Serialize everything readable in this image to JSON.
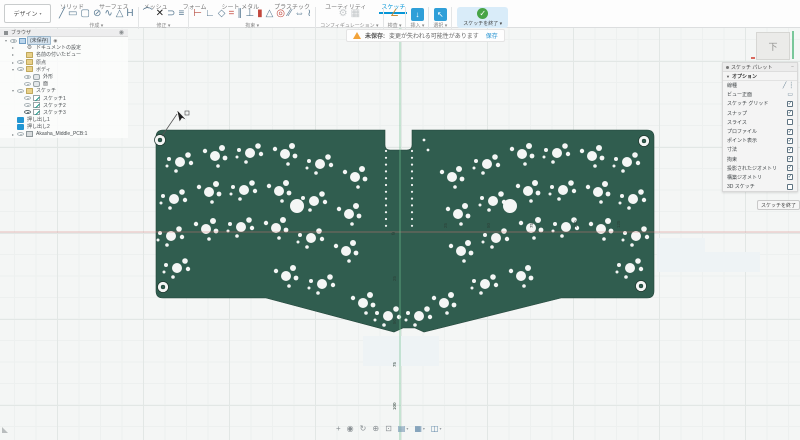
{
  "toolbar": {
    "design_label": "デザイン",
    "tabs": [
      {
        "label": "ソリッド",
        "active": false
      },
      {
        "label": "サーフェス",
        "active": false
      },
      {
        "label": "メッシュ",
        "active": false
      },
      {
        "label": "フォーム",
        "active": false
      },
      {
        "label": "シート メタル",
        "active": false
      },
      {
        "label": "プラスチック",
        "active": false
      },
      {
        "label": "ユーティリティ",
        "active": false
      },
      {
        "label": "スケッチ",
        "active": true
      }
    ],
    "groups": [
      {
        "label": "作成",
        "icons": [
          {
            "name": "line-icon",
            "glyph": "╱",
            "color": "#5b7c94"
          },
          {
            "name": "rectangle-icon",
            "glyph": "▭",
            "color": "#5b7c94"
          },
          {
            "name": "slot-icon",
            "glyph": "▢",
            "color": "#5b7c94"
          },
          {
            "name": "circle-icon",
            "glyph": "⊘",
            "color": "#5b7c94"
          },
          {
            "name": "spline-icon",
            "glyph": "∿",
            "color": "#5b7c94"
          },
          {
            "name": "polygon-icon",
            "glyph": "△",
            "color": "#5b7c94"
          },
          {
            "name": "text-icon",
            "glyph": "H",
            "color": "#5b7c94"
          }
        ]
      },
      {
        "label": "修正",
        "icons": [
          {
            "name": "fillet-icon",
            "glyph": "⌒",
            "color": "#5b7c94"
          },
          {
            "name": "trim-icon",
            "glyph": "✕",
            "color": "#222222"
          },
          {
            "name": "extend-icon",
            "glyph": "⊃",
            "color": "#5b7c94"
          },
          {
            "name": "offset-icon",
            "glyph": "≡",
            "color": "#5b7c94"
          }
        ]
      },
      {
        "label": "拘束",
        "icons": [
          {
            "name": "sketch-dimension-icon",
            "glyph": "⊢",
            "color": "#b5483d"
          },
          {
            "name": "horizontal-vertical-icon",
            "glyph": "∟",
            "color": "#5b7c94"
          },
          {
            "name": "coincident-icon",
            "glyph": "◇",
            "color": "#5b7c94"
          },
          {
            "name": "equal-icon",
            "glyph": "=",
            "color": "#c2473c"
          },
          {
            "name": "parallel-icon",
            "glyph": "∥",
            "color": "#5b7c94"
          },
          {
            "name": "perpendicular-icon",
            "glyph": "⊥",
            "color": "#5b7c94"
          },
          {
            "name": "fix-icon",
            "glyph": "▮",
            "color": "#c2473c"
          },
          {
            "name": "midpoint-icon",
            "glyph": "△",
            "color": "#5b7c94"
          },
          {
            "name": "concentric-icon",
            "glyph": "◎",
            "color": "#c2473c"
          },
          {
            "name": "collinear-icon",
            "glyph": "∕∕",
            "color": "#5b7c94"
          },
          {
            "name": "symmetry-icon",
            "glyph": "⇔",
            "color": "#5b7c94"
          },
          {
            "name": "curvature-icon",
            "glyph": "≀",
            "color": "#5b7c94"
          }
        ]
      },
      {
        "label": "コンフィギュレーション",
        "grayed": true,
        "icons": [
          {
            "name": "configure-icon",
            "glyph": "⚙",
            "color": "#c6cacc"
          },
          {
            "name": "config-table-icon",
            "glyph": "▦",
            "color": "#c6cacc"
          }
        ]
      },
      {
        "label": "検査",
        "icons": [
          {
            "name": "measure-icon",
            "glyph": "∠",
            "color": "#c78f3c"
          }
        ]
      },
      {
        "label": "挿入",
        "icons": [
          {
            "name": "insert-icon",
            "glyph": "↓",
            "color": "#ffffff",
            "bg": "#2f9fd8"
          }
        ]
      },
      {
        "label": "選択",
        "icons": [
          {
            "name": "select-icon",
            "glyph": "↖",
            "color": "#ffffff",
            "bg": "#2f9fd8"
          }
        ]
      }
    ],
    "finish_label": "スケッチを終了"
  },
  "warning": {
    "prefix": "未保存:",
    "message": "変更が失われる可能性があります",
    "action": "保存"
  },
  "browser": {
    "title": "ブラウザ",
    "rows": [
      {
        "label": "(未保存)",
        "icon": "document",
        "arrow": "open",
        "eye": 1,
        "ind": 0,
        "sel": true,
        "badge": "◉"
      },
      {
        "label": "ドキュメントの設定",
        "icon": "gear",
        "arrow": "closed",
        "eye": 0,
        "ind": 1
      },
      {
        "label": "名前の付いたビュー",
        "icon": "folder",
        "arrow": "closed",
        "eye": 0,
        "ind": 1
      },
      {
        "label": "原点",
        "icon": "folder",
        "arrow": "closed",
        "eye": 1,
        "ind": 1
      },
      {
        "label": "ボディ",
        "icon": "folder",
        "arrow": "open",
        "eye": 1,
        "ind": 1
      },
      {
        "label": "外形",
        "icon": "body",
        "eye": 1,
        "ind": 2
      },
      {
        "label": "面",
        "icon": "body",
        "eye": 1,
        "ind": 2
      },
      {
        "label": "スケッチ",
        "icon": "folder",
        "arrow": "open",
        "eye": 1,
        "ind": 1
      },
      {
        "label": "スケッチ1",
        "icon": "sketch",
        "eye": 1,
        "ind": 2
      },
      {
        "label": "スケッチ2",
        "icon": "sketch",
        "eye": 1,
        "ind": 2
      },
      {
        "label": "スケッチ3",
        "icon": "sketch",
        "eye": 2,
        "ind": 2
      },
      {
        "label": "押し出し1",
        "icon": "extrude",
        "ind": 1
      },
      {
        "label": "押し出し2",
        "icon": "extrude",
        "ind": 1
      },
      {
        "label": "Akasha_Middle_PCB:1",
        "icon": "component",
        "arrow": "closed",
        "eye": 1,
        "ind": 1
      }
    ]
  },
  "palette": {
    "title": "スケッチ パレット",
    "section": "オプション",
    "rows": [
      {
        "label": "線種",
        "ctrl": "icons"
      },
      {
        "label": "ビュー正面",
        "ctrl": "icon"
      },
      {
        "label": "スケッチ グリッド",
        "ctrl": "check",
        "checked": true
      },
      {
        "label": "スナップ",
        "ctrl": "check",
        "checked": true
      },
      {
        "label": "スライス",
        "ctrl": "check",
        "checked": false
      },
      {
        "label": "プロファイル",
        "ctrl": "check",
        "checked": true
      },
      {
        "label": "ポイント表示",
        "ctrl": "check",
        "checked": true
      },
      {
        "label": "寸法",
        "ctrl": "check",
        "checked": true
      },
      {
        "label": "拘束",
        "ctrl": "check",
        "checked": true
      },
      {
        "label": "投影されたジオメトリ",
        "ctrl": "check",
        "checked": true
      },
      {
        "label": "構築ジオメトリ",
        "ctrl": "check",
        "checked": true
      },
      {
        "label": "3D スケッチ",
        "ctrl": "check",
        "checked": false
      }
    ],
    "finish_label": "スケッチを終了"
  },
  "viewcube": {
    "face_label": "下"
  },
  "navbar": {
    "icons": [
      {
        "name": "pan-icon",
        "glyph": "+"
      },
      {
        "name": "look-at-icon",
        "glyph": "◉"
      },
      {
        "name": "orbit-icon",
        "glyph": "↻"
      },
      {
        "name": "zoom-icon",
        "glyph": "⊕"
      },
      {
        "name": "fit-icon",
        "glyph": "⊡"
      },
      {
        "name": "display-settings-icon",
        "glyph": "▤",
        "caret": true,
        "bluish": true
      },
      {
        "name": "grid-snap-icon",
        "glyph": "▦",
        "caret": true,
        "bluish": true
      },
      {
        "name": "viewports-icon",
        "glyph": "◫",
        "caret": true,
        "bluish": true
      }
    ]
  },
  "canvas": {
    "colors": {
      "board": "#305d4f",
      "board_edge": "#23453a",
      "hole": "#f4f6f5",
      "axis_x": "rgba(216,122,118,0.6)",
      "axis_y": "rgba(108,190,142,0.85)",
      "label": "#2c3f37"
    },
    "board_path": "M156,137 Q156,130 163,130 L385,130 L385,145 Q385,150 390,150 L407,150 Q412,150 412,145 L412,130 L647,130 Q654,130 654,137 L654,291 Q654,298 647,298 L561,298 L424,332 L415,328 L403,328 L394,332 L266,298 L163,298 Q156,298 156,291 Z",
    "origin_symbol": "⌀",
    "axis_x_y": 232,
    "axis_y_x": 400,
    "mirror_x": 807,
    "screw_holes": [
      [
        160,
        140
      ],
      [
        163,
        287
      ],
      [
        644,
        141
      ],
      [
        641,
        286
      ]
    ],
    "big_holes": [
      [
        297,
        206
      ],
      [
        510,
        206
      ]
    ],
    "clusters_left": [
      [
        180,
        162
      ],
      [
        215,
        156
      ],
      [
        250,
        153
      ],
      [
        285,
        154
      ],
      [
        320,
        164
      ],
      [
        355,
        177
      ],
      [
        174,
        199
      ],
      [
        209,
        192
      ],
      [
        244,
        190
      ],
      [
        279,
        191
      ],
      [
        314,
        201
      ],
      [
        349,
        214
      ],
      [
        171,
        236
      ],
      [
        206,
        229
      ],
      [
        241,
        227
      ],
      [
        276,
        228
      ],
      [
        311,
        238
      ],
      [
        346,
        251
      ],
      [
        177,
        268
      ],
      [
        286,
        276
      ],
      [
        322,
        284
      ],
      [
        363,
        303
      ],
      [
        388,
        316
      ]
    ],
    "patterns": [
      [
        [
          0,
          0,
          5
        ],
        [
          8,
          -7,
          2.8
        ],
        [
          11,
          1,
          2.2
        ],
        [
          -11,
          -3,
          2
        ],
        [
          -4,
          9,
          1.8
        ],
        [
          -13,
          4,
          1.5
        ]
      ],
      [
        [
          0,
          0,
          5
        ],
        [
          7,
          -8,
          3
        ],
        [
          10,
          2,
          2.4
        ],
        [
          -10,
          -5,
          2.2
        ],
        [
          3,
          10,
          1.8
        ]
      ]
    ],
    "dot_columns": [
      {
        "x": 386,
        "y0": 151,
        "y1": 232,
        "step": 6.8
      },
      {
        "x": 412,
        "y0": 151,
        "y1": 232,
        "step": 6.8
      }
    ],
    "extra_dots": [
      [
        424,
        140
      ],
      [
        428,
        150
      ]
    ],
    "grid_labels_h": [
      {
        "t": "25",
        "x": 447,
        "y": 228
      },
      {
        "t": "50",
        "x": 490,
        "y": 228
      },
      {
        "t": "75",
        "x": 533,
        "y": 228
      },
      {
        "t": "100",
        "x": 577,
        "y": 228
      },
      {
        "t": "125",
        "x": 620,
        "y": 228
      }
    ],
    "grid_labels_v": [
      {
        "t": "25",
        "x": 396,
        "y": 281
      },
      {
        "t": "50",
        "x": 396,
        "y": 324
      },
      {
        "t": "75",
        "x": 396,
        "y": 367
      },
      {
        "t": "100",
        "x": 396,
        "y": 410
      }
    ],
    "pale_rects": [
      [
        363,
        336,
        76,
        30
      ],
      [
        657,
        238,
        48,
        34
      ],
      [
        700,
        252,
        60,
        20
      ]
    ],
    "cursor": {
      "line": [
        162,
        136,
        177,
        114
      ],
      "tip": [
        177,
        110
      ]
    }
  }
}
